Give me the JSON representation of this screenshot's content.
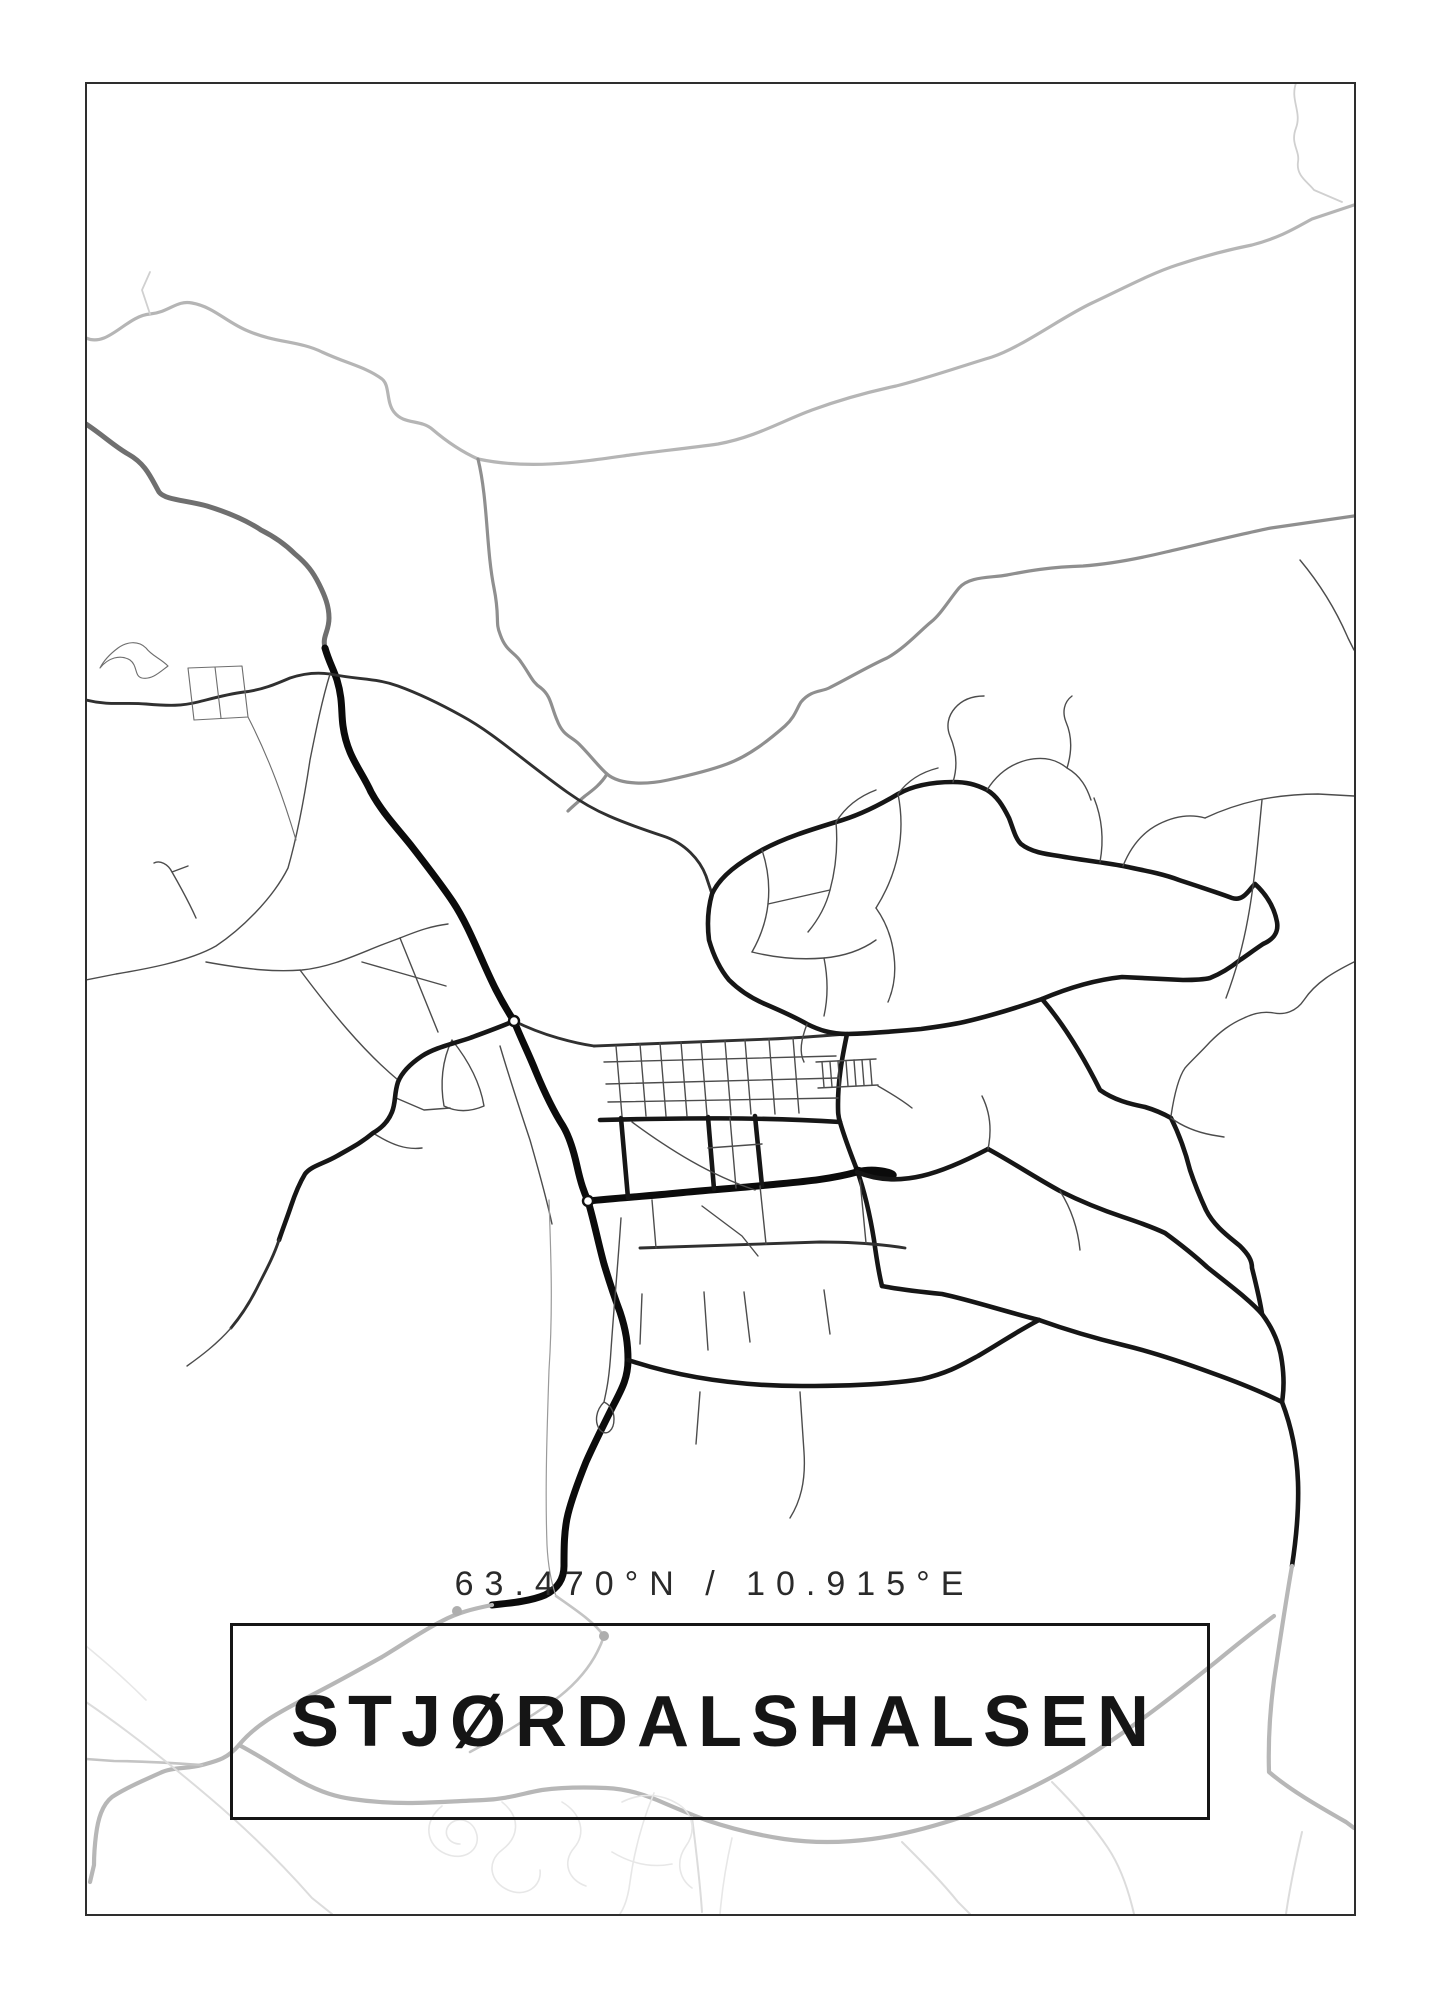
{
  "poster": {
    "title": "STJØRDALSHALSEN",
    "coordinates": "63.470°N / 10.915°E",
    "colors": {
      "background": "#ffffff",
      "frame": "#2e2e2e",
      "title": "#151515",
      "coordinates": "#2a2a2a",
      "road_dark": "#0b0b0b",
      "river_gray": "#8f8f8f",
      "gray_road": "#b7b7b7"
    },
    "map": {
      "roads": [
        {
          "class": "rivL",
          "d": "M86,338 C108,348 126,316 150,314 C170,312 176,300 192,303 C214,307 226,322 248,331 C276,343 300,341 322,352 C348,364 366,367 382,379 C390,385 386,402 394,412 C404,425 420,419 432,429 C446,441 460,451 478,459"
        },
        {
          "class": "rivL",
          "d": "M478,459 C530,470 580,462 630,455 C660,451 690,448 718,444 C756,437 782,421 812,410 C842,399 868,392 896,386 C928,378 962,366 992,357 C1022,347 1062,317 1092,303 C1122,289 1152,273 1177,265 C1207,255 1232,249 1252,245 C1282,237 1297,227 1312,219 L1354,205"
        },
        {
          "class": "rivT",
          "d": "M1296,83 C1290,100 1302,112 1296,128 C1290,144 1300,150 1298,162 C1296,176 1308,182 1314,190 L1342,202"
        },
        {
          "class": "rivT",
          "d": "M150,314 L142,290 L150,272"
        },
        {
          "class": "riv",
          "d": "M478,459 C488,500 486,548 494,588 C500,618 495,622 500,634 C506,652 515,652 521,662 C531,676 532,682 541,688 C551,696 551,706 557,720 C563,736 571,736 579,744 C591,756 598,766 607,774"
        },
        {
          "class": "riv",
          "d": "M607,774 C621,786 650,784 668,780 C691,775 711,770 727,764 C749,756 769,740 785,726 C795,717 797,708 801,702 C811,690 821,692 829,688 C849,678 869,666 887,658 C905,648 921,630 931,622 C941,614 949,600 959,588 C969,576 991,578 1007,575 C1023,572 1047,567 1083,566 C1111,564 1141,558 1166,552 C1201,544 1241,534 1271,528 L1354,516"
        },
        {
          "class": "riv",
          "d": "M607,774 C601,784 593,790 585,796 C579,801 573,806 568,811"
        },
        {
          "class": "ghwy",
          "d": "M86,424 C104,436 114,446 128,454 C146,464 151,478 159,492 C165,500 185,500 207,506 C233,514 249,522 261,530 C277,538 287,546 295,554 C307,564 313,572 319,584 C325,596 329,606 329,618 C329,632 322,636 325,648"
        },
        {
          "class": "hwy",
          "d": "M325,648 C329,662 333,668 337,680 C343,700 341,712 343,726 C347,756 361,770 371,792 C383,814 399,830 413,848 C427,866 441,884 453,902 C465,920 475,944 483,962 C491,980 499,998 514,1021"
        },
        {
          "class": "mid",
          "d": "M86,700 C110,706 124,702 146,704 C170,706 182,706 198,702 C214,698 228,694 244,692 C262,690 276,684 290,678 C302,674 316,672 330,674"
        },
        {
          "class": "mid",
          "d": "M330,674 C360,680 376,678 398,686 C420,694 444,706 462,716 C484,728 504,744 522,758 C540,772 553,782 567,792 C581,802 595,810 609,816 C627,824 645,830 663,836 C685,843 700,860 706,876 L712,894"
        },
        {
          "class": "minor",
          "d": "M330,674 C322,700 316,730 310,760 C304,800 296,840 288,868 C272,900 240,930 216,946 C188,962 140,970 116,974 L86,980"
        },
        {
          "class": "minor",
          "d": "M196,918 C188,900 180,886 172,872 C168,864 160,860 154,863"
        },
        {
          "class": "minor",
          "d": "M172,872 L188,866"
        },
        {
          "class": "minor2",
          "d": "M100,668 C108,658 120,654 130,660 C138,666 134,676 142,678 C152,680 160,672 168,666 C160,658 152,656 146,648 C138,640 126,642 118,648 C110,654 104,660 100,668"
        },
        {
          "class": "minor2",
          "d": "M188,668 L194,720 L248,717 L242,666 Z"
        },
        {
          "class": "minor2",
          "d": "M215,667 L221,718"
        },
        {
          "class": "minor2",
          "d": "M248,717 C270,760 284,800 296,840"
        },
        {
          "class": "minor",
          "d": "M206,962 C250,970 276,972 302,970 C332,967 358,954 384,944 L400,938"
        },
        {
          "class": "minor",
          "d": "M400,938 L438,1032"
        },
        {
          "class": "minor",
          "d": "M400,938 C420,930 432,926 448,924"
        },
        {
          "class": "minor",
          "d": "M362,962 L446,986"
        },
        {
          "class": "minor",
          "d": "M300,970 C330,1010 362,1050 398,1080"
        },
        {
          "class": "minor",
          "d": "M396,1098 L424,1110 L450,1108"
        },
        {
          "class": "minor",
          "d": "M373,1133 C392,1145 406,1150 422,1148"
        },
        {
          "class": "minor",
          "d": "M452,1040 C468,1060 480,1082 484,1106 C470,1112 456,1112 444,1106 C440,1084 442,1060 452,1040"
        },
        {
          "class": "minor",
          "d": "M500,1046 C510,1080 520,1110 530,1140 C538,1168 546,1196 552,1224"
        },
        {
          "class": "hwy",
          "d": "M514,1021 C522,1041 528,1052 536,1072 C546,1096 554,1112 563,1126 C569,1136 573,1148 577,1166 C581,1184 584,1192 588,1201 C594,1221 598,1242 604,1264 C610,1284 614,1296 620,1312 C626,1330 628,1344 628,1360 C628,1380 620,1392 612,1408 C602,1428 594,1444 586,1462 C578,1482 572,1498 568,1514 C564,1530 564,1548 564,1566 C564,1580 557,1589 545,1595 C531,1601 512,1603 492,1605"
        },
        {
          "class": "major",
          "d": "M514,1021 C500,1027 486,1032 470,1038 C452,1044 434,1048 422,1056 C410,1064 402,1072 398,1082 C394,1094 396,1102 392,1112 C388,1122 380,1129 373,1133 C361,1143 351,1148 337,1156 C323,1164 311,1166 305,1174 C299,1184 295,1194 291,1206 C287,1218 283,1228 279,1240"
        },
        {
          "class": "mid",
          "d": "M279,1240 C273,1258 265,1272 257,1288 C249,1304 241,1316 231,1328"
        },
        {
          "class": "minor",
          "d": "M231,1328 C217,1344 201,1356 187,1366"
        },
        {
          "class": "mid",
          "d": "M514,1021 C530,1029 544,1034 558,1038 C572,1042 580,1044 594,1046"
        },
        {
          "class": "mid",
          "d": "M594,1046 C654,1044 714,1041 771,1039 C796,1038 822,1036 847,1034"
        },
        {
          "class": "major",
          "d": "M847,1034 C842,1058 838,1080 838,1104 C838,1112 838,1116 840,1122 C844,1136 850,1152 857,1170 C864,1190 870,1215 874,1240 C877,1262 879,1274 882,1286"
        },
        {
          "class": "hwy",
          "d": "M588,1201 C618,1198 648,1196 678,1193 C708,1190 738,1188 768,1185 C798,1182 828,1180 857,1172 C888,1164 920,1186 857,1170 M588,1201 C618,1198 648,1196 678,1193 C708,1190 738,1188 768,1185 C798,1182 828,1180 857,1172"
        },
        {
          "class": "major",
          "d": "M857,1172 C900,1190 944,1172 988,1149"
        },
        {
          "class": "major",
          "d": "M600,1120 C680,1118 760,1117 840,1122"
        },
        {
          "class": "major",
          "d": "M621,1118 L628,1198"
        },
        {
          "class": "major",
          "d": "M708,1117 L714,1189"
        },
        {
          "class": "major",
          "d": "M755,1116 L762,1186"
        },
        {
          "class": "minor",
          "d": "M708,1148 L762,1144"
        },
        {
          "class": "minor",
          "d": "M730,1118 L736,1188"
        },
        {
          "class": "mid",
          "d": "M640,1248 C700,1246 760,1244 820,1242 C850,1242 880,1244 905,1248"
        },
        {
          "class": "minor",
          "d": "M652,1200 L656,1248"
        },
        {
          "class": "minor",
          "d": "M760,1186 L766,1244"
        },
        {
          "class": "minor",
          "d": "M860,1180 L866,1243"
        },
        {
          "class": "minor",
          "d": "M632,1122 C670,1150 710,1175 755,1190"
        },
        {
          "class": "minor",
          "d": "M616,1046 L622,1116"
        },
        {
          "class": "minor",
          "d": "M640,1044 L646,1116"
        },
        {
          "class": "minor",
          "d": "M660,1043 L666,1116"
        },
        {
          "class": "minor",
          "d": "M681,1042 L687,1116"
        },
        {
          "class": "minor",
          "d": "M701,1042 L707,1115"
        },
        {
          "class": "minor",
          "d": "M725,1041 L731,1115"
        },
        {
          "class": "minor",
          "d": "M745,1040 L751,1114"
        },
        {
          "class": "minor",
          "d": "M769,1039 L775,1114"
        },
        {
          "class": "minor",
          "d": "M793,1038 L799,1113"
        },
        {
          "class": "minor",
          "d": "M604,1062 L836,1056"
        },
        {
          "class": "minor",
          "d": "M606,1084 L838,1078"
        },
        {
          "class": "minor",
          "d": "M608,1102 L838,1098"
        },
        {
          "class": "minor",
          "d": "M642,1294 L640,1344"
        },
        {
          "class": "minor",
          "d": "M704,1292 L708,1350"
        },
        {
          "class": "minor",
          "d": "M744,1292 L750,1342"
        },
        {
          "class": "minor",
          "d": "M824,1290 L830,1334"
        },
        {
          "class": "minor",
          "d": "M702,1206 L742,1236 L758,1256"
        },
        {
          "class": "minor",
          "d": "M621,1218 C618,1264 614,1306 611,1350 C609,1382 606,1392 604,1402 C596,1410 594,1422 600,1430 C607,1437 614,1430 614,1419 C614,1410 610,1405 604,1402"
        },
        {
          "class": "rail",
          "d": "M549,1200 C551,1255 553,1310 549,1370 C547,1430 545,1490 547,1545 C548,1565 551,1582 556,1596"
        },
        {
          "class": "minor",
          "d": "M800,1392 L804,1452 C806,1482 800,1502 790,1518"
        },
        {
          "class": "minor",
          "d": "M700,1392 L696,1444"
        },
        {
          "class": "major",
          "d": "M628,1360 C682,1378 742,1386 802,1386 C852,1386 892,1384 922,1379 C952,1372 966,1362 978,1356 C1002,1342 1016,1332 1039,1320"
        },
        {
          "class": "major",
          "d": "M712,894 C720,876 740,862 762,850 C784,838 810,830 836,822 C858,816 878,806 898,794 C916,784 936,782 953,782 C966,782 975,784 987,790 C997,796 1003,806 1009,818 C1013,828 1015,838 1021,844 C1031,852 1045,854 1059,856 C1081,860 1101,862 1123,866 C1147,871 1163,874 1179,880 C1197,886 1216,892 1232,898 C1244,902 1250,888 1255,884 C1266,894 1274,906 1277,922 C1279,934 1272,940 1263,944 C1254,950 1246,956 1240,960 C1230,968 1220,974 1210,978 C1202,980 1192,980 1183,980 C1162,979 1142,978 1122,977 C1094,980 1068,988 1042,999 C1016,1008 990,1016 964,1022 C950,1025 936,1027 921,1029 C900,1031 878,1033 847,1034 C831,1034 819,1030 807,1024 C793,1016 779,1010 765,1004 C751,998 739,990 729,980 C719,968 713,954 709,940 C707,924 708,908 712,894 Z"
        },
        {
          "class": "minor",
          "d": "M816,1062 L876,1059"
        },
        {
          "class": "minor",
          "d": "M818,1088 L878,1085"
        },
        {
          "class": "minor",
          "d": "M822,1062 L824,1087"
        },
        {
          "class": "minor",
          "d": "M830,1062 L832,1087"
        },
        {
          "class": "minor",
          "d": "M838,1061 L840,1086"
        },
        {
          "class": "minor",
          "d": "M846,1061 L848,1086"
        },
        {
          "class": "minor",
          "d": "M854,1060 L856,1086"
        },
        {
          "class": "minor",
          "d": "M862,1060 L864,1085"
        },
        {
          "class": "minor",
          "d": "M870,1060 L872,1085"
        },
        {
          "class": "minor",
          "d": "M807,1024 C801,1040 799,1052 804,1062"
        },
        {
          "class": "minor",
          "d": "M878,1086 C892,1094 902,1100 912,1108"
        },
        {
          "class": "minor",
          "d": "M762,850 C768,868 770,886 768,904 C766,922 760,938 752,952"
        },
        {
          "class": "minor",
          "d": "M836,822 C838,846 836,868 830,890 C826,906 818,920 808,932"
        },
        {
          "class": "minor",
          "d": "M898,794 C902,814 902,834 898,854 C894,874 886,892 876,908"
        },
        {
          "class": "minor",
          "d": "M752,952 C776,958 800,960 824,958 C846,956 862,950 876,940"
        },
        {
          "class": "minor",
          "d": "M876,908 C886,922 892,938 894,956 C896,972 894,988 888,1002"
        },
        {
          "class": "minor",
          "d": "M768,904 L830,890"
        },
        {
          "class": "minor",
          "d": "M824,958 C828,978 828,998 824,1016"
        },
        {
          "class": "minor",
          "d": "M953,782 C958,766 956,750 950,736 C946,726 948,716 955,708 C962,700 972,696 984,696"
        },
        {
          "class": "minor",
          "d": "M987,790 C997,774 1011,764 1027,760 C1045,756 1057,760 1067,768 C1081,776 1087,788 1091,800"
        },
        {
          "class": "minor",
          "d": "M1067,768 C1072,752 1072,736 1066,722 C1062,712 1064,702 1072,696"
        },
        {
          "class": "minor",
          "d": "M1123,866 C1131,846 1143,832 1159,824 C1175,816 1191,814 1205,818"
        },
        {
          "class": "minor",
          "d": "M898,794 C908,780 922,772 938,768"
        },
        {
          "class": "minor",
          "d": "M836,822 C846,806 860,796 876,790"
        },
        {
          "class": "minor",
          "d": "M1205,818 C1222,810 1240,804 1258,800 C1278,796 1298,794 1318,794 L1354,796"
        },
        {
          "class": "minor",
          "d": "M1100,862 C1104,840 1102,818 1094,798"
        },
        {
          "class": "minor",
          "d": "M1262,800 C1258,840 1255,880 1248,918 C1243,946 1235,974 1226,998"
        },
        {
          "class": "minor",
          "d": "M1300,560 C1320,584 1336,610 1348,638 L1354,650"
        },
        {
          "class": "major",
          "d": "M988,1149 C1012,1162 1036,1178 1060,1191 C1082,1202 1102,1210 1123,1217 C1138,1222 1152,1227 1165,1233 C1180,1244 1194,1255 1207,1267 C1228,1284 1250,1300 1262,1314 C1274,1330 1280,1346 1282,1362 C1284,1376 1284,1390 1282,1402"
        },
        {
          "class": "major",
          "d": "M882,1286 C902,1290 922,1292 942,1294 C970,1300 1000,1310 1039,1320 C1067,1330 1094,1338 1123,1345 C1152,1352 1182,1362 1212,1373 C1240,1383 1262,1392 1282,1402"
        },
        {
          "class": "major",
          "d": "M1042,999 C1060,1020 1080,1050 1100,1090 C1114,1100 1130,1104 1145,1107 C1155,1110 1164,1114 1171,1118 C1180,1136 1186,1154 1190,1170 C1196,1188 1200,1197 1206,1210 C1214,1226 1228,1236 1240,1246 C1248,1254 1252,1260 1252,1268 C1256,1284 1260,1300 1262,1314"
        },
        {
          "class": "minor",
          "d": "M1354,962 C1334,972 1316,982 1304,1000 C1296,1012 1284,1015 1274,1013 C1263,1011 1252,1014 1244,1018 C1230,1024 1220,1032 1210,1042 C1200,1053 1190,1062 1185,1068 C1178,1078 1174,1096 1171,1116"
        },
        {
          "class": "minor",
          "d": "M1171,1118 C1182,1126 1196,1132 1212,1135 L1224,1137"
        },
        {
          "class": "minor",
          "d": "M1060,1191 C1072,1210 1078,1230 1080,1250"
        },
        {
          "class": "minor",
          "d": "M988,1149 C992,1130 990,1112 982,1096"
        },
        {
          "class": "major",
          "d": "M1282,1402 C1292,1428 1297,1455 1298,1482 C1299,1512 1296,1540 1292,1566"
        },
        {
          "class": "gray",
          "d": "M1292,1566 C1286,1600 1280,1640 1274,1680 C1270,1710 1268,1740 1269,1772 C1290,1790 1318,1806 1346,1822 L1354,1828"
        },
        {
          "class": "gray",
          "d": "M492,1605 C472,1609 457,1613 442,1621 C422,1631 402,1645 382,1657 C357,1671 332,1685 308,1697 C282,1711 257,1723 239,1745 C227,1759 217,1761 202,1765 C187,1769 172,1767 160,1773 C142,1781 124,1789 112,1797 C102,1805 98,1819 96,1835 C94,1851 94,1859 94,1865 L90,1882"
        },
        {
          "class": "gray2",
          "d": "M202,1765 C172,1763 142,1761 114,1761 L86,1759"
        },
        {
          "class": "gray",
          "d": "M239,1745 C262,1757 282,1771 300,1781 C322,1793 338,1797 352,1799 C372,1802 390,1803 408,1803 C434,1803 458,1801 484,1800 C508,1799 524,1793 542,1790 C564,1787 584,1787 606,1788 C628,1789 646,1795 664,1803 C678,1809 692,1815 706,1820 C732,1829 758,1835 784,1839 C812,1843 842,1843 872,1839 C902,1835 932,1827 962,1817 C992,1807 1022,1793 1052,1777 C1082,1761 1112,1741 1142,1719 C1167,1701 1192,1681 1217,1661 C1240,1642 1258,1628 1274,1616"
        },
        {
          "class": "gray2",
          "d": "M556,1596 C576,1610 594,1622 604,1636 C596,1660 580,1680 560,1696 C530,1718 500,1736 470,1752"
        },
        {
          "class": "faint",
          "d": "M692,1817 C696,1849 700,1881 702,1912"
        },
        {
          "class": "faint",
          "d": "M1302,1832 C1296,1858 1290,1886 1286,1914"
        },
        {
          "class": "faint",
          "d": "M86,1702 C130,1732 170,1764 210,1798 C250,1832 282,1864 312,1898 L332,1914"
        },
        {
          "class": "faint2",
          "d": "M86,1646 C108,1664 128,1682 146,1700"
        },
        {
          "class": "faint2",
          "d": "M442,1806 C422,1822 426,1846 446,1854 C466,1862 482,1848 476,1832 C472,1820 458,1816 450,1824 C442,1832 448,1844 460,1844"
        },
        {
          "class": "faint2",
          "d": "M502,1802 C522,1818 518,1838 502,1850 C486,1862 490,1882 508,1890 C526,1898 542,1886 540,1870"
        },
        {
          "class": "faint2",
          "d": "M562,1802 C582,1814 586,1834 574,1848 C562,1862 568,1880 586,1886"
        },
        {
          "class": "faint2",
          "d": "M622,1802 C642,1792 662,1794 678,1804 C694,1814 696,1832 686,1846 C676,1860 678,1878 692,1888"
        },
        {
          "class": "faint2",
          "d": "M612,1852 C632,1864 652,1868 672,1864"
        },
        {
          "class": "faint2",
          "d": "M654,1793 C642,1822 634,1852 630,1882 C628,1898 624,1908 620,1914"
        },
        {
          "class": "faint2",
          "d": "M732,1838 C726,1864 722,1890 720,1914"
        },
        {
          "class": "faint",
          "d": "M902,1842 C922,1862 942,1882 958,1902 L970,1914"
        },
        {
          "class": "faint",
          "d": "M1052,1782 C1072,1802 1092,1824 1108,1848 C1120,1866 1128,1888 1134,1914"
        }
      ],
      "nodes": [
        {
          "cx": 514,
          "cy": 1021,
          "r": 5,
          "class": "rb"
        },
        {
          "cx": 588,
          "cy": 1201,
          "r": 5,
          "class": "rb"
        },
        {
          "cx": 457,
          "cy": 1611,
          "r": 5,
          "class": "gdot"
        },
        {
          "cx": 604,
          "cy": 1636,
          "r": 5,
          "class": "gdot"
        }
      ]
    }
  }
}
